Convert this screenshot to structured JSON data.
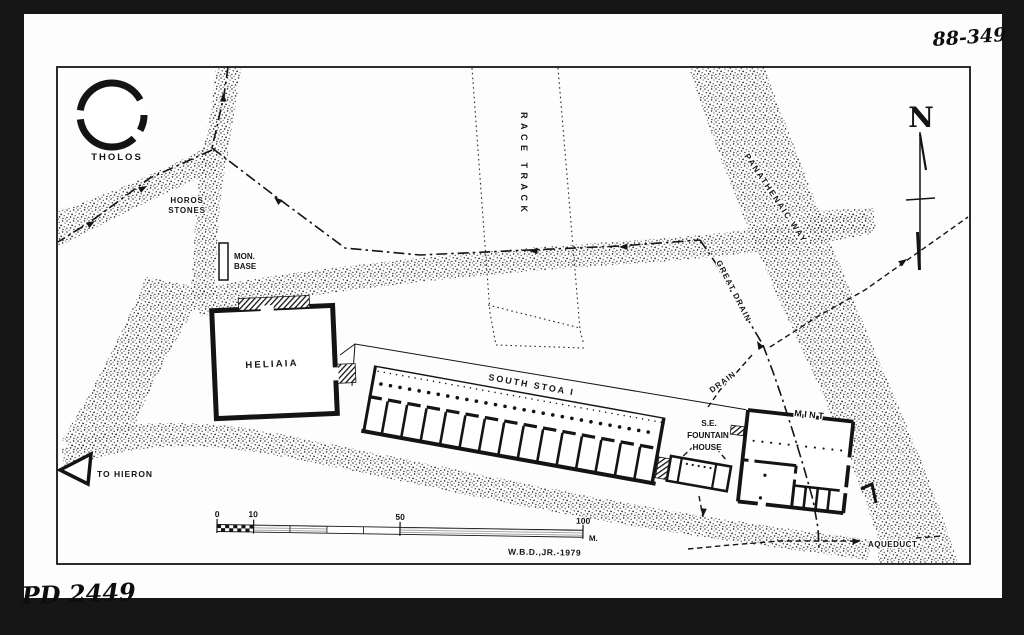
{
  "document": {
    "catalog_top_right": "88-349",
    "catalog_bottom_left": "PD 2449"
  },
  "map": {
    "labels": {
      "tholos": "THOLOS",
      "horos_stones_line1": "HOROS",
      "horos_stones_line2": "STONES",
      "mon_base_line1": "MON.",
      "mon_base_line2": "BASE",
      "race_track": "RACE TRACK",
      "panathenaic_way": "PANATHENAIC  WAY",
      "great_drain": "GREAT  DRAIN",
      "drain": "DRAIN",
      "heliaia": "HELIAIA",
      "south_stoa": "SOUTH STOA I",
      "se_fountain_line1": "S.E.",
      "se_fountain_line2": "FOUNTAIN",
      "se_fountain_line3": "HOUSE",
      "mint": "MINT",
      "to_hieron": "TO HIERON",
      "aqueduct": "AQUEDUCT"
    },
    "compass": {
      "north": "N"
    },
    "scale_bar": {
      "tick_0": "0",
      "tick_10": "10",
      "tick_50": "50",
      "tick_100": "100",
      "unit": "M.",
      "credit": "W.B.D.,JR.-1979"
    },
    "colors": {
      "background": "#161616",
      "paper": "#fdfdfd",
      "ink": "#141414",
      "stipple": "#262626"
    }
  }
}
